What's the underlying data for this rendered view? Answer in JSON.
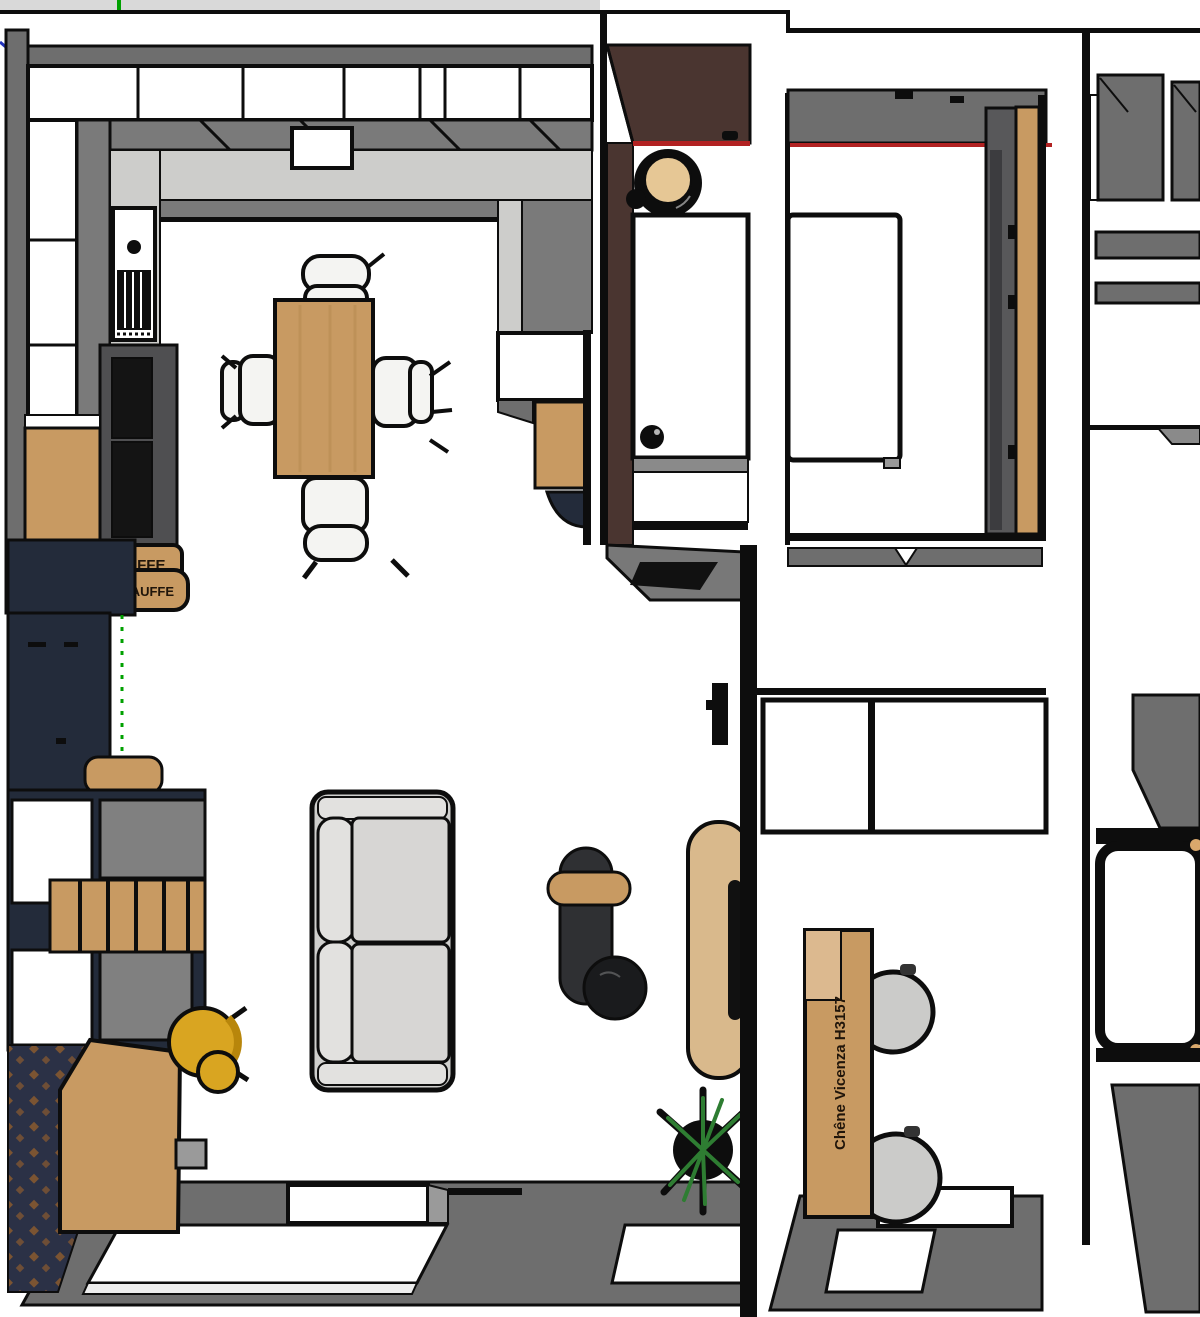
{
  "labels": {
    "chauffe_board_1": "ÇA CHAUFFE",
    "chauffe_board_2": "CHAUFFE",
    "desk_edge_label": "Chêne Vicenza H3157"
  },
  "palette": {
    "topbar": "#d9d9d9",
    "axis_green": "#00a000",
    "axis_blue": "#2233bb",
    "black": "#0d0d0d",
    "wall": "#6e6e6e",
    "counter": "#7a7a7a",
    "dark_unit": "#4f4f51",
    "marble": "#cdcdcb",
    "wood": "#c89a62",
    "wood_light": "#dcb98f",
    "tan": "#d9b98c",
    "navy": "#232b3a",
    "dark_brown": "#4a3530",
    "red_accent": "#b22222",
    "sofa": "#cfcfcd",
    "cushion": "#d7d6d4",
    "cushion_light": "#e2e1df",
    "yellow": "#d9a521",
    "yellow_dark": "#b8860b",
    "rug": "#2b3146",
    "rug_accent": "#8a5a2f",
    "plant": "#2e7d32",
    "chair_white": "#f4f4f2",
    "office_chair": "#cbcbc9",
    "glass_gray": "#8a8a8a",
    "gray_face": "#808080",
    "engrave": "#20150a",
    "pill_table": "#2f3033",
    "marble_black": "#1a1b1d",
    "wardrobe_gray": "#58585a",
    "wardrobe_gloss": "#3c3c3f"
  },
  "inventory": {
    "left_apartment": [
      "kitchen",
      "dining-table",
      "four-chairs",
      "tall-navy-cabinet",
      "sideboard",
      "wood-desk",
      "yellow-stool",
      "rug",
      "sofa",
      "coffee-table-set",
      "plant",
      "oval-side-table"
    ],
    "entry": [
      "dark-brown-wardrobe",
      "round-mirror",
      "white-door"
    ],
    "middle_apartment": [
      "bed",
      "wardrobe-with-oak-door",
      "study-desk",
      "two-office-chairs"
    ],
    "right_apartment": [
      "cabinets",
      "shelves",
      "armchair",
      "bathtub",
      "balcony-floor"
    ]
  }
}
